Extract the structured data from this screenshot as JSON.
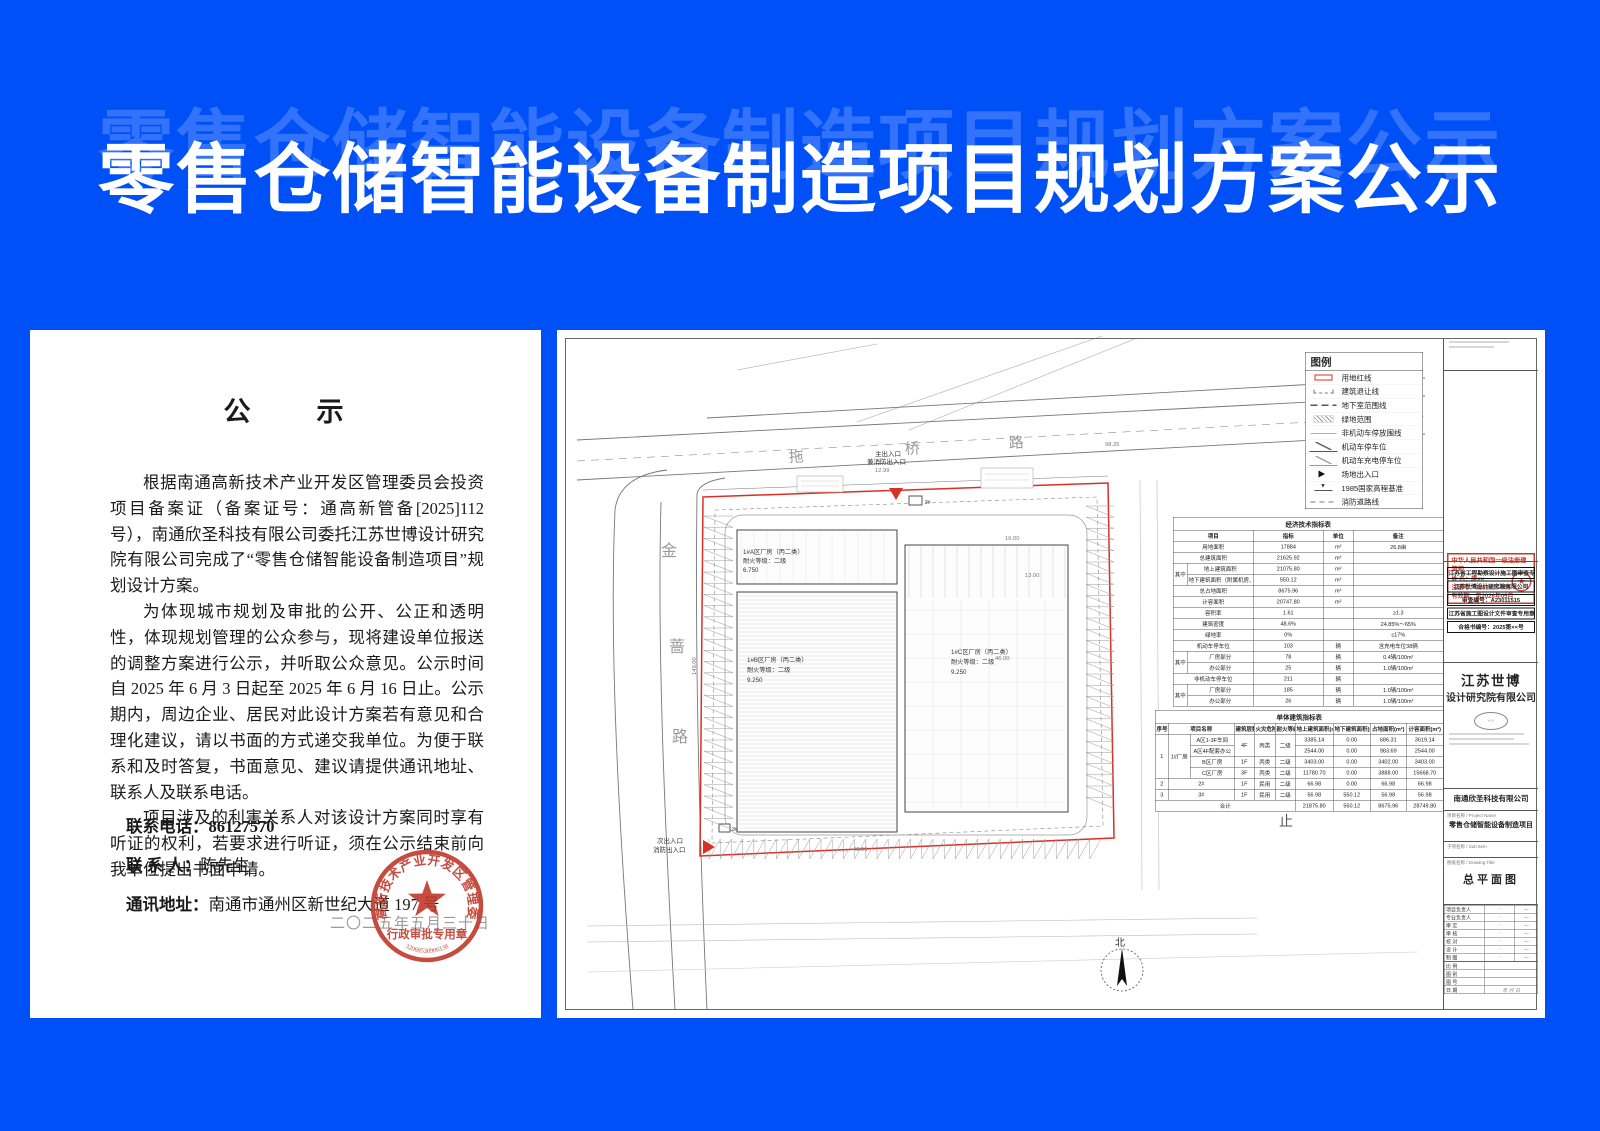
{
  "colors": {
    "background_blue": "#0050f8",
    "boundary_red": "#d93025",
    "seal_red": "#c0392b"
  },
  "banner": {
    "title": "零售仓储智能设备制造项目规划方案公示"
  },
  "notice": {
    "heading": "公　　示",
    "paragraphs": [
      "根据南通高新技术产业开发区管理委员会投资项目备案证（备案证号：通高新管备[2025]112 号），南通欣圣科技有限公司委托江苏世博设计研究院有限公司完成了“零售仓储智能设备制造项目”规划设计方案。",
      "为体现城市规划及审批的公开、公正和透明性，体现规划管理的公众参与，现将建设单位报送的调整方案进行公示，并听取公众意见。公示时间自 2025 年 6 月 3 日起至 2025 年 6 月 16 日止。公示期内，周边企业、居民对此设计方案若有意见和合理化建议，请以书面的方式递交我单位。为便于联系和及时答复，书面意见、建议请提供通讯地址、联系人及联系电话。",
      "项目涉及的利害关系人对该设计方案同时享有听证的权利，若要求进行听证，须在公示结束前向我单位提出书面申请。"
    ],
    "contacts": [
      {
        "label": "联系电话：",
        "value": "86127570"
      },
      {
        "label": "联 系 人：",
        "value": "陈先生"
      },
      {
        "label": "通讯地址：",
        "value": "南通市通州区新世纪大道 197 号"
      }
    ],
    "date_watermark": "二〇二五年五月三十日",
    "seal": {
      "ring_text": "南通高新技术产业开发区管理委员会",
      "center_title": "行政审批专用章",
      "serial": "32068530906138"
    }
  },
  "plan": {
    "roads": {
      "top": [
        "拖",
        "桥",
        "路"
      ],
      "left": [
        "金",
        "蔷",
        "路"
      ]
    },
    "entrances": [
      {
        "label": "主出入口",
        "sub": "兼消防出入口"
      },
      {
        "label": "次出入口",
        "sub": "消防出入口"
      }
    ],
    "buildings": [
      {
        "lines": [
          "1#A区厂房（丙二类）",
          "耐火等级：二级",
          "6.750"
        ]
      },
      {
        "lines": [
          "1#B区厂房（丙二类）",
          "耐火等级：二级",
          "9.250"
        ]
      },
      {
        "lines": [
          "1#C区厂房（丙二类）",
          "耐火等级：二级",
          "9.250"
        ]
      }
    ],
    "small_buildings": [
      "2#",
      "3#"
    ],
    "north": "北",
    "stray_label": "止",
    "annotations": [
      {
        "t": "12.99",
        "x": 318,
        "y": 142
      },
      {
        "t": "98.35",
        "x": 548,
        "y": 116
      },
      {
        "t": "16.00",
        "x": 448,
        "y": 210
      },
      {
        "t": "13.00",
        "x": 468,
        "y": 247
      },
      {
        "t": "46.00",
        "x": 438,
        "y": 330
      },
      {
        "t": "40.00",
        "x": 296,
        "y": 521
      },
      {
        "t": "149.00",
        "x": 139,
        "y": 345,
        "r": -90
      }
    ],
    "legend": {
      "title": "图例",
      "items": [
        {
          "label": "用地红线",
          "sym": "redrect"
        },
        {
          "label": "建筑退让线",
          "sym": "setback"
        },
        {
          "label": "地下室范围线",
          "sym": "dash"
        },
        {
          "label": "绿地范围",
          "sym": "hatch"
        },
        {
          "label": "非机动车停放围线",
          "sym": "thin"
        },
        {
          "label": "机动车停车位",
          "sym": "zmark"
        },
        {
          "label": "机动车充电停车位",
          "sym": "zmark2"
        },
        {
          "label": "场地出入口",
          "sym": "tri"
        },
        {
          "label": "1985国家高程基准",
          "sym": "elev"
        },
        {
          "label": "消防道路线",
          "sym": "firedash"
        }
      ]
    }
  },
  "tables": {
    "t1": {
      "title": "经济技术指标表",
      "rows": [
        [
          {
            "t": "项目",
            "cs": 2,
            "h": 1
          },
          {
            "t": "指标",
            "h": 1
          },
          {
            "t": "单位",
            "h": 1
          },
          {
            "t": "备注",
            "h": 1
          }
        ],
        [
          {
            "t": "用地面积",
            "cs": 2
          },
          {
            "t": "17884"
          },
          {
            "t": "m²"
          },
          {
            "t": "26.8亩"
          }
        ],
        [
          {
            "t": "总建筑面积",
            "cs": 2
          },
          {
            "t": "21625.92"
          },
          {
            "t": "m²"
          },
          {
            "t": ""
          }
        ],
        [
          {
            "t": "其中",
            "rs": 2
          },
          {
            "t": "地上建筑面积"
          },
          {
            "t": "21075.80"
          },
          {
            "t": "m²"
          },
          {
            "t": ""
          }
        ],
        [
          {
            "t": "地下建筑面积（附属机房、消防泵房）"
          },
          {
            "t": "550.12"
          },
          {
            "t": "m²"
          },
          {
            "t": ""
          }
        ],
        [
          {
            "t": "总占地面积",
            "cs": 2
          },
          {
            "t": "8675.96"
          },
          {
            "t": "m²"
          },
          {
            "t": ""
          }
        ],
        [
          {
            "t": "计容面积",
            "cs": 2
          },
          {
            "t": "20747.80"
          },
          {
            "t": "m²"
          },
          {
            "t": ""
          }
        ],
        [
          {
            "t": "容积率",
            "cs": 2
          },
          {
            "t": "1.61"
          },
          {
            "t": ""
          },
          {
            "t": "≥1.3"
          }
        ],
        [
          {
            "t": "建筑密度",
            "cs": 2
          },
          {
            "t": "48.6%"
          },
          {
            "t": ""
          },
          {
            "t": "24.85%～65%"
          }
        ],
        [
          {
            "t": "绿地率",
            "cs": 2
          },
          {
            "t": "0%"
          },
          {
            "t": ""
          },
          {
            "t": "≤17%"
          }
        ],
        [
          {
            "t": "机动车停车位",
            "cs": 2
          },
          {
            "t": "103"
          },
          {
            "t": "辆"
          },
          {
            "t": "含充电车位38辆"
          }
        ],
        [
          {
            "t": "其中",
            "rs": 2
          },
          {
            "t": "厂房部分"
          },
          {
            "t": "78"
          },
          {
            "t": "辆"
          },
          {
            "t": "0.4辆/100m²"
          }
        ],
        [
          {
            "t": "办公部分"
          },
          {
            "t": "25"
          },
          {
            "t": "辆"
          },
          {
            "t": "1.0辆/100m²"
          }
        ],
        [
          {
            "t": "非机动车停车位",
            "cs": 2
          },
          {
            "t": "211"
          },
          {
            "t": "辆"
          },
          {
            "t": ""
          }
        ],
        [
          {
            "t": "其中",
            "rs": 2
          },
          {
            "t": "厂房部分"
          },
          {
            "t": "185"
          },
          {
            "t": "辆"
          },
          {
            "t": "1.0辆/100m²"
          }
        ],
        [
          {
            "t": "办公部分"
          },
          {
            "t": "26"
          },
          {
            "t": "辆"
          },
          {
            "t": "1.0辆/100m²"
          }
        ]
      ]
    },
    "t2": {
      "title": "单体建筑指标表",
      "rows": [
        [
          {
            "t": "序号",
            "h": 1
          },
          {
            "t": "项目名称",
            "cs": 2,
            "h": 1
          },
          {
            "t": "建筑层数",
            "h": 1
          },
          {
            "t": "火灾危险性",
            "h": 1
          },
          {
            "t": "耐火等级",
            "h": 1
          },
          {
            "t": "地上建筑面积(m²)",
            "h": 1
          },
          {
            "t": "地下建筑面积(m²)",
            "h": 1
          },
          {
            "t": "占地面积(m²)",
            "h": 1
          },
          {
            "t": "计容面积(m²)",
            "h": 1
          }
        ],
        [
          {
            "t": "1",
            "rs": 4
          },
          {
            "t": "1#厂房",
            "rs": 4
          },
          {
            "t": "A区1-3F车间"
          },
          {
            "t": "4F",
            "rs": 2
          },
          {
            "t": "丙类",
            "rs": 2
          },
          {
            "t": "二级",
            "rs": 2
          },
          {
            "t": "3385.14"
          },
          {
            "t": "0.00"
          },
          {
            "t": "686.31"
          },
          {
            "t": "3619.14"
          }
        ],
        [
          {
            "t": "A区4F配套办公"
          },
          {
            "t": "2544.00"
          },
          {
            "t": "0.00"
          },
          {
            "t": "983.69"
          },
          {
            "t": "2544.00"
          }
        ],
        [
          {
            "t": "B区厂房"
          },
          {
            "t": "1F"
          },
          {
            "t": "丙类"
          },
          {
            "t": "二级"
          },
          {
            "t": "3403.00"
          },
          {
            "t": "0.00"
          },
          {
            "t": "3402.00"
          },
          {
            "t": "3403.00"
          }
        ],
        [
          {
            "t": "C区厂房"
          },
          {
            "t": "3F"
          },
          {
            "t": "丙类"
          },
          {
            "t": "二级"
          },
          {
            "t": "11780.70"
          },
          {
            "t": "0.00"
          },
          {
            "t": "3888.00"
          },
          {
            "t": "15668.70"
          }
        ],
        [
          {
            "t": "2"
          },
          {
            "t": "2#",
            "cs": 2
          },
          {
            "t": "1F"
          },
          {
            "t": "民用"
          },
          {
            "t": "二级"
          },
          {
            "t": "66.98"
          },
          {
            "t": "0.00"
          },
          {
            "t": "66.98"
          },
          {
            "t": "66.98"
          }
        ],
        [
          {
            "t": "3"
          },
          {
            "t": "3#",
            "cs": 2
          },
          {
            "t": "1F"
          },
          {
            "t": "民用"
          },
          {
            "t": "二级"
          },
          {
            "t": "56.98"
          },
          {
            "t": "550.12"
          },
          {
            "t": "56.98"
          },
          {
            "t": "56.98"
          }
        ],
        [
          {
            "t": "合计",
            "cs": 6
          },
          {
            "t": "21875.80"
          },
          {
            "t": "550.12"
          },
          {
            "t": "8675.96"
          },
          {
            "t": "28749.80"
          }
        ]
      ]
    }
  },
  "titleblock": {
    "reg_stamp": {
      "title": "中华人民共和国一级注册建筑师",
      "name": "姓 名：唐××",
      "number": "注册号：3201826-005",
      "valid": "有效期：至2026年05月",
      "star": "★"
    },
    "audit_stamps": [
      "江苏省工程勘察设计施工图审查专用章",
      "江苏世博设计研究院有限公司",
      "审查编号：A23011515",
      "江苏省施工图设计文件审查专用章",
      "合格书编号：2025第××号"
    ],
    "company": {
      "line1": "江苏世博",
      "line2": "设计研究院有限公司"
    },
    "client": "南通欣圣科技有限公司",
    "project_label": "项目名称 / Project Name",
    "project_name": "零售仓储智能设备制造项目",
    "subitem_label": "子项名称 / Sub Item",
    "sheet_label": "图纸名称 / Drawing Title",
    "sheet_name": "总平面图",
    "sign_rows": [
      [
        "项目负责人",
        "〜"
      ],
      [
        "专业负责人",
        "〜"
      ],
      [
        "审 定",
        "〜"
      ],
      [
        "审 核",
        "〜"
      ],
      [
        "校 对",
        "〜"
      ],
      [
        "设 计",
        "〜"
      ],
      [
        "制 图",
        "〜"
      ]
    ],
    "meta_rows": [
      [
        "比 例",
        ""
      ],
      [
        "图 别",
        ""
      ],
      [
        "图 号",
        ""
      ],
      [
        "日 期",
        "年 月 日"
      ]
    ]
  }
}
